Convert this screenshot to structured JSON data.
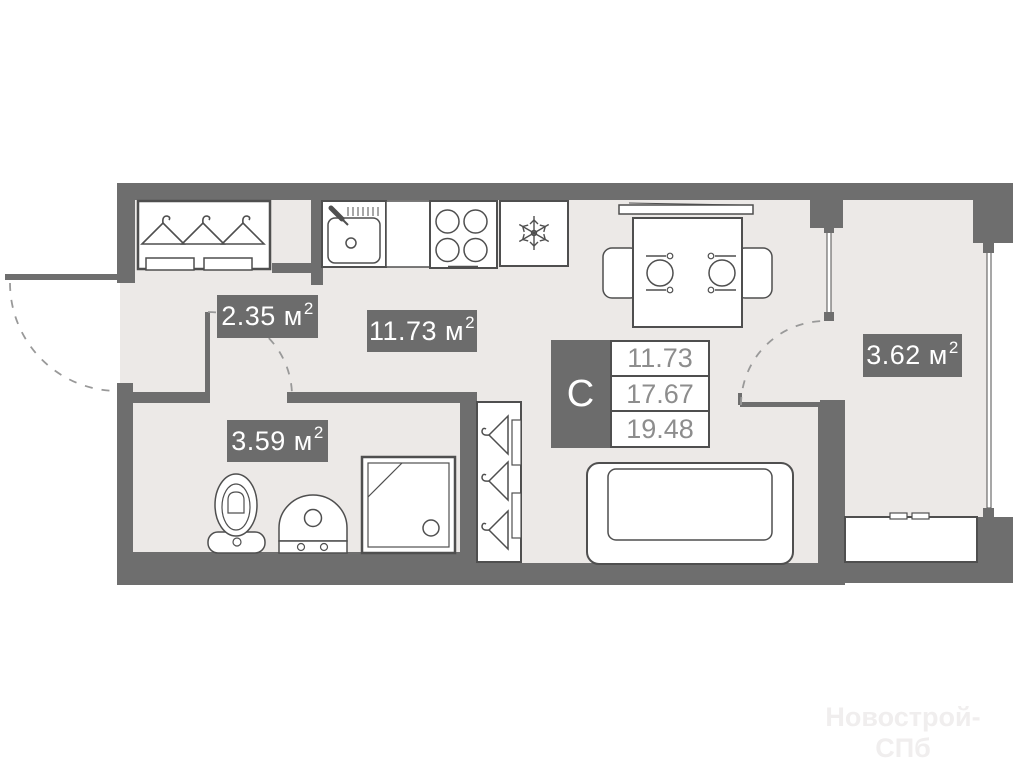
{
  "plan": {
    "colors": {
      "wall": "#6e6e6e",
      "floor": "#ece9e7",
      "fixture_outline": "#4f4f4f",
      "label_bg": "#6c6c6c",
      "label_text": "#ffffff",
      "legend_number_text": "#8d8d8d",
      "door_arc": "#999999",
      "watermark_text": "#f0eeee"
    },
    "legend": {
      "letter": "С",
      "values": [
        "11.73",
        "17.67",
        "19.48"
      ]
    },
    "room_labels": [
      {
        "id": "hallway",
        "text": "2.35 м",
        "sup": "2"
      },
      {
        "id": "kitchen-living",
        "text": "11.73 м",
        "sup": "2"
      },
      {
        "id": "bathroom",
        "text": "3.59 м",
        "sup": "2"
      },
      {
        "id": "balcony",
        "text": "3.62 м",
        "sup": "2"
      }
    ],
    "watermark": "Новострой-СПб"
  }
}
